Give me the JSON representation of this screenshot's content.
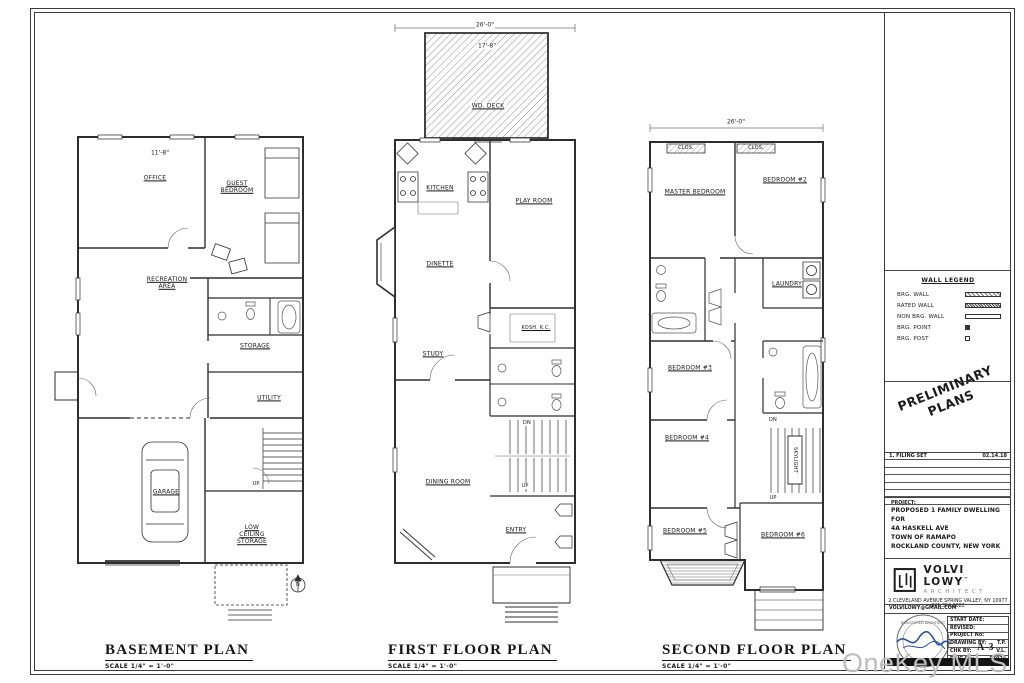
{
  "sheet": {
    "watermark": "OneKey MLS"
  },
  "north_label": "N",
  "plans": {
    "basement": {
      "title": "BASEMENT PLAN",
      "scale": "SCALE  1/4\" = 1'-0\"",
      "rooms": {
        "office": "OFFICE",
        "guest_bedroom": "GUEST BEDROOM",
        "recreation": "RECREATION AREA",
        "storage": "STORAGE",
        "utility": "UTILITY",
        "garage": "GARAGE",
        "low_ceiling_storage": "LOW CEILING STORAGE"
      },
      "labels": {
        "up": "UP"
      },
      "dims": {
        "office_width": "11'-8\""
      }
    },
    "first_floor": {
      "title": "FIRST FLOOR PLAN",
      "scale": "SCALE  1/4\" = 1'-0\"",
      "rooms": {
        "deck": "WD. DECK",
        "kitchen": "KITCHEN",
        "play_room": "PLAY ROOM",
        "dinette": "DINETTE",
        "kosher_kitchen": "KOSH. K.C.",
        "study": "STUDY",
        "dining_room": "DINING ROOM",
        "entry": "ENTRY"
      },
      "labels": {
        "dn": "DN",
        "up": "UP"
      },
      "dims": {
        "overall_width": "26'-0\"",
        "deck_width": "17'-8\""
      }
    },
    "second_floor": {
      "title": "SECOND FLOOR PLAN",
      "scale": "SCALE  1/4\" = 1'-0\"",
      "rooms": {
        "master_bedroom": "MASTER BEDROOM",
        "bedroom_2": "BEDROOM #2",
        "laundry": "LAUNDRY",
        "bedroom_3": "BEDROOM #3",
        "bedroom_4": "BEDROOM #4",
        "bedroom_5": "BEDROOM #5",
        "bedroom_6": "BEDROOM #6",
        "skylight": "SKYLIGHT"
      },
      "labels": {
        "dn": "DN",
        "up": "UP",
        "closet_1": "CLOS.",
        "closet_2": "CLOS."
      },
      "dims": {
        "overall_width": "26'-0\""
      }
    }
  },
  "title_block": {
    "wall_legend": {
      "title": "WALL LEGEND",
      "items": [
        {
          "label": "BRG. WALL"
        },
        {
          "label": "RATED WALL"
        },
        {
          "label": "NON BRG. WALL"
        },
        {
          "label": "BRG. POINT"
        },
        {
          "label": "BRG. POST"
        }
      ]
    },
    "preliminary_line1": "PRELIMINARY",
    "preliminary_line2": "PLANS",
    "revisions": {
      "row1_no": "1.",
      "row1_label": "FILING SET",
      "row1_date": "02.14.18"
    },
    "project": {
      "label": "PROJECT:",
      "line1": "PROPOSED 1 FAMILY DWELLING FOR",
      "line2": "4A HASKELL AVE",
      "line3": "TOWN OF RAMAPO",
      "line4": "ROCKLAND COUNTY, NEW YORK"
    },
    "firm": {
      "name": "VOLVI LOWY",
      "tm": "™",
      "subtitle": "ARCHITECT",
      "address": "2 CLEVELAND AVENUE SPRING VALLEY, NY 10977  845.354.2082",
      "email": "VOLVILOWY@GMAIL.COM"
    },
    "info": {
      "rows": [
        {
          "label": "START DATE:",
          "value": ""
        },
        {
          "label": "REVISED:",
          "value": ""
        },
        {
          "label": "PROJECT No:",
          "value": ""
        },
        {
          "label": "DRAWING BY:",
          "value": "T.P."
        },
        {
          "label": "CHK BY:",
          "value": "V.L."
        },
        {
          "label": "DWG No:",
          "value": "17029"
        }
      ]
    },
    "stamp": {
      "text_top": "REGISTERED ARCHITECT",
      "text_bottom": "STATE OF NEW YORK"
    },
    "sheet_no": "A-3"
  }
}
